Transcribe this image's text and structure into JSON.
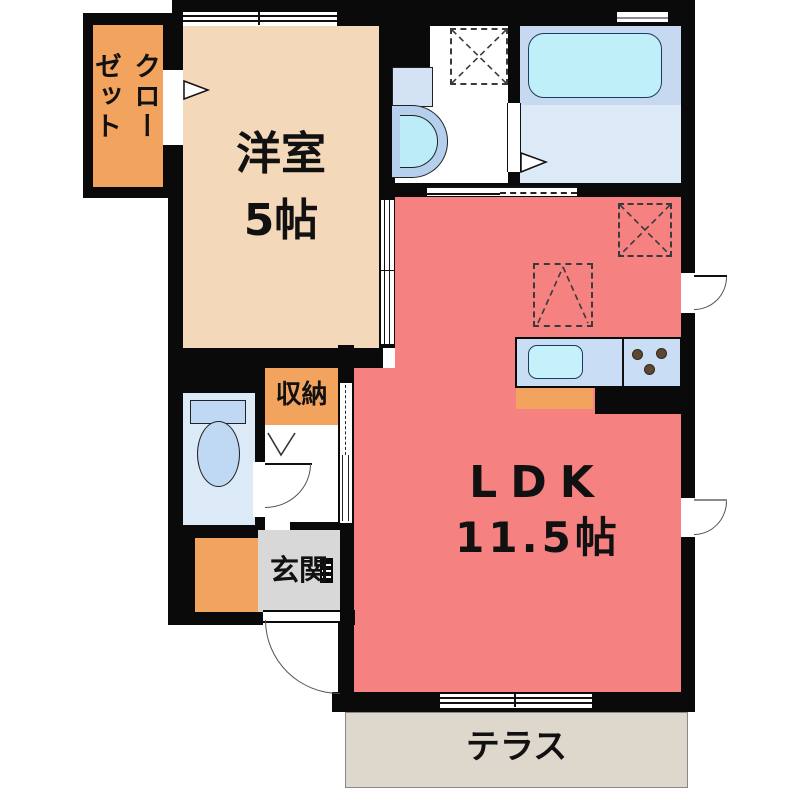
{
  "plan_title": "1LDK apartment floor plan",
  "rooms": {
    "closet": {
      "label": "クローゼット"
    },
    "western_room": {
      "label": "洋室",
      "size": "5帖"
    },
    "ldk": {
      "label": "LDK",
      "size": "11.5帖"
    },
    "storage": {
      "label": "収納"
    },
    "entrance": {
      "label": "玄関"
    },
    "terrace": {
      "label": "テラス"
    }
  },
  "fixtures": [
    "bathtub",
    "washbasin",
    "washing-machine-space",
    "toilet",
    "kitchen-sink",
    "gas-stove",
    "refrigerator-space",
    "shoe-cabinet"
  ],
  "colors": {
    "wall": "#0a0a0a",
    "western_room": "#F4D8BA",
    "closet": "#F2A45F",
    "storage": "#F2A45F",
    "ldk": "#F58181",
    "entrance_floor": "#D8D8D8",
    "entrance_step": "#F2A45F",
    "terrace": "#DED7CC",
    "bath_zone": "#C7D9F0",
    "bath_floor": "#DCE9F7",
    "bathtub": "#BFF0FA",
    "toilet_floor": "#DCE9F7",
    "toilet_fixture": "#BFD9F4",
    "washbasin_outer": "#B5D0EC",
    "washbasin_inner": "#BBECF8",
    "kitchen_counter": "#C9DDF5",
    "kitchen_sink": "#C4F1FA",
    "burner": "#5D4733"
  }
}
